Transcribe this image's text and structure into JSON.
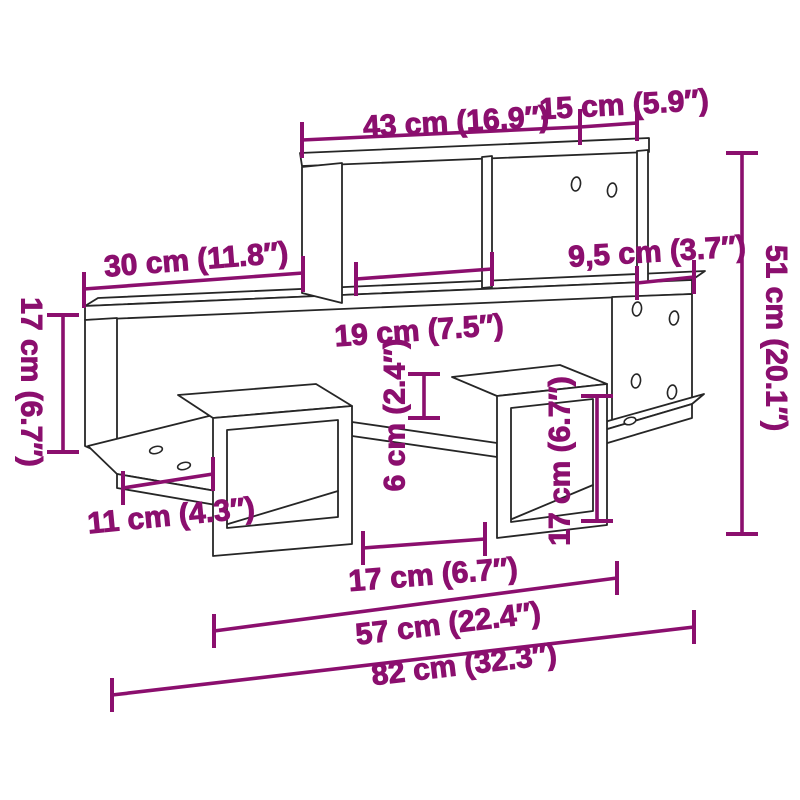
{
  "diagram": {
    "background": "#ffffff",
    "line_color": "#262626",
    "dimension_color": "#8B0F6E",
    "units": "cm / inches"
  },
  "dims": [
    {
      "name": "top-shelf-width",
      "label": "43 cm (16.9″)"
    },
    {
      "name": "top-right-width",
      "label": "15 cm (5.9″)"
    },
    {
      "name": "left-shelf-width",
      "label": "30 cm (11.8″)"
    },
    {
      "name": "right-overhang-width",
      "label": "9,5 cm (3.7″)"
    },
    {
      "name": "total-height",
      "label": "51 cm (20.1″)"
    },
    {
      "name": "left-section-height",
      "label": "17 cm (6.7″)"
    },
    {
      "name": "top-compartment-width",
      "label": "19 cm (7.5″)"
    },
    {
      "name": "middle-gap-height",
      "label": "6 cm (2.4″)"
    },
    {
      "name": "right-cube-height",
      "label": "17 cm (6.7″)"
    },
    {
      "name": "bottom-left-width",
      "label": "11 cm (4.3″)"
    },
    {
      "name": "bottom-gap-width",
      "label": "17 cm (6.7″)"
    },
    {
      "name": "inner-span-width",
      "label": "57 cm (22.4″)"
    },
    {
      "name": "total-width",
      "label": "82 cm (32.3″)"
    }
  ]
}
